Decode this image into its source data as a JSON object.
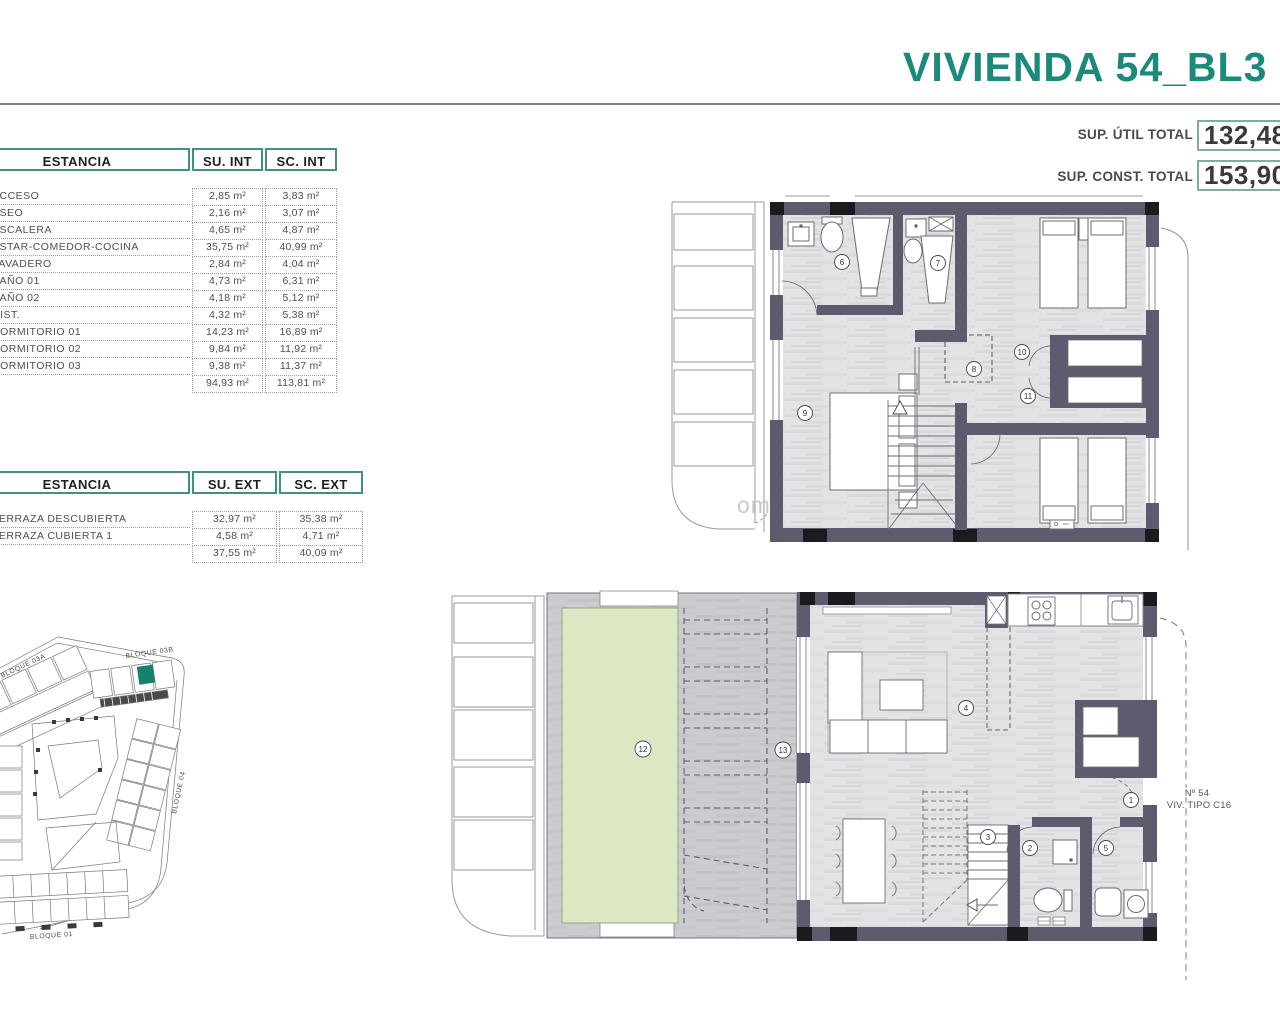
{
  "title": "VIVIENDA 54_BL3",
  "accent_color": "#1c8a7a",
  "summary": {
    "util_label": "SUP. ÚTIL TOTAL",
    "util_value": "132,48",
    "const_label": "SUP. CONST. TOTAL",
    "const_value": "153,90"
  },
  "interior_table": {
    "headers": [
      "ESTANCIA",
      "SU. INT",
      "SC. INT"
    ],
    "rows": [
      [
        "ACCESO",
        "2,85 m²",
        "3,83 m²"
      ],
      [
        "ASEO",
        "2,16 m²",
        "3,07 m²"
      ],
      [
        "ESCALERA",
        "4,65 m²",
        "4,87 m²"
      ],
      [
        "ESTAR-COMEDOR-COCINA",
        "35,75 m²",
        "40,99 m²"
      ],
      [
        "LAVADERO",
        "2,84 m²",
        "4,04 m²"
      ],
      [
        "BAÑO 01",
        "4,73 m²",
        "6,31 m²"
      ],
      [
        "BAÑO 02",
        "4,18 m²",
        "5,12 m²"
      ],
      [
        "DIST.",
        "4,32 m²",
        "5,38 m²"
      ],
      [
        "DORMITORIO 01",
        "14,23 m²",
        "16,89 m²"
      ],
      [
        "DORMITORIO 02",
        "9,84 m²",
        "11,92 m²"
      ],
      [
        "DORMITORIO 03",
        "9,38 m²",
        "11,37 m²"
      ]
    ],
    "total": [
      "94,93 m²",
      "113,81 m²"
    ]
  },
  "exterior_table": {
    "headers": [
      "ESTANCIA",
      "SU. EXT",
      "SC. EXT"
    ],
    "rows": [
      [
        "TERRAZA DESCUBIERTA",
        "32,97 m²",
        "35,38 m²"
      ],
      [
        "TERRAZA CUBIERTA 1",
        "4,58 m²",
        "4,71 m²"
      ]
    ],
    "total": [
      "37,55 m²",
      "40,09 m²"
    ]
  },
  "upper_floor": {
    "room_numbers": [
      "6",
      "7",
      "8",
      "9",
      "10",
      "11"
    ]
  },
  "ground_floor": {
    "room_numbers": [
      "1",
      "2",
      "3",
      "4",
      "5",
      "12",
      "13"
    ],
    "unit_label_line1": "Nº 54",
    "unit_label_line2": "VIV. TIPO C16"
  },
  "site_plan": {
    "labels": [
      "BLOQUE 03A",
      "BLOQUE 03B",
      "BLOQUE 04",
      "BLOQUE 01"
    ],
    "highlight_color": "#17816f"
  },
  "watermark": "om"
}
